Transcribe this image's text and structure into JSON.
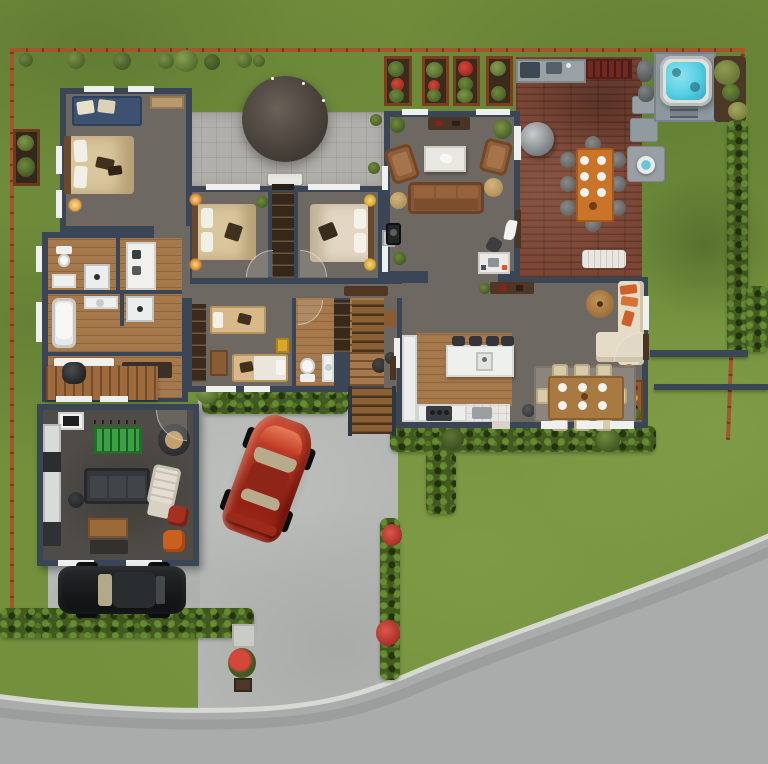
{
  "meta": {
    "kind": "architectural-site-plan-render",
    "view": "top-down",
    "canvas": {
      "width": 768,
      "height": 764
    },
    "visible_text": "none"
  },
  "palette": {
    "grass": "#73913d",
    "grassLight": "#8aa94e",
    "grassDark": "#55702c",
    "road": "#a9acaa",
    "curb": "#d9dbd5",
    "driveway": "#b6b8b6",
    "parkingPad": "#b0b2b0",
    "fence": "#a3562c",
    "fenceDark": "#713a18",
    "hedge": "#42591f",
    "hedgeLight": "#5d7a2e",
    "shrub": "#4f6b28",
    "tree": "#62793a",
    "soil": "#4c3826",
    "planterFrame": "#96502a",
    "flowerRed": "#c03228",
    "wall": "#3a4556",
    "floor": "#6e6862",
    "wood": "#a5794b",
    "woodDark": "#7c5432",
    "paver": "#b1afa9",
    "canopy": "#4a433c",
    "tile": "#e6e5e1",
    "rug": "#8b857d",
    "rugDark": "#33312e",
    "deck": "#7b4636",
    "counterGray": "#9aa1a4",
    "grillRed": "#6f2921",
    "steel": "#3c4854",
    "hotTubWater": "#54cfe2",
    "hotTubShell": "#dfe0de",
    "concretePad": "#8d979e",
    "rock": "#596063",
    "white": "#eef0ee",
    "cream": "#e6dcc6",
    "bedCream": "#d9c69c",
    "bedLight": "#e2d7c2",
    "tan": "#c4a36a",
    "pillowDark": "#42301f",
    "headboard": "#6a4a2e",
    "blueBench": "#3d5270",
    "sofaBrown": "#86573a",
    "armBrown": "#8e5f3a",
    "orange": "#cf5f28",
    "orangeTable": "#c97429",
    "chairTan": "#d8cbaa",
    "tableWood": "#a87940",
    "barWood": "#8a5c30",
    "consoleWood": "#503723",
    "darkWood": "#35271a",
    "island": "#eef0ee",
    "stool": "#333537",
    "appliance": "#3a3d3f",
    "black": "#232526",
    "gameFloor": "#4f4b46",
    "felt": "#3aa244",
    "poufRed": "#a33122",
    "poufOrange": "#cd5f1d",
    "sofaDark": "#35383b",
    "lounge": "#e3ddd0",
    "kitchenette": "#d9dbd9",
    "carRed": "#b23321",
    "carRedDark": "#8f2014",
    "carBlack": "#1b1d1f",
    "glass": "#b3a888",
    "lampGlow": "#ffb347",
    "yellowArt": "#d9a62e",
    "doorWood": "#4a3422",
    "outdoorChair": "#6e6e6c",
    "lowWall": "#3a4556",
    "gravel": "#98a0a5"
  },
  "site": {
    "ground": [
      "lawn",
      "street-curved-bottom-right",
      "sidewalk-curb",
      "driveway",
      "parking-pad"
    ],
    "boundary": [
      "fence-top",
      "fence-left",
      "fence-right"
    ],
    "greenery": [
      "hedge-front-left",
      "hedge-south-of-house",
      "hedge-spur",
      "hedge-lower-left",
      "hedge-east-fence",
      "hedge-northeast",
      "flower-bed-strip",
      "flower-bushes",
      "raised-beds-x4",
      "left-planter-box",
      "fence-line-shrubs",
      "trees-by-hot-tub"
    ],
    "hardscape": [
      "stone-path-pads",
      "boulders",
      "trash-pad",
      "exterior-wood-steps",
      "pergola-patio"
    ]
  },
  "house": {
    "wall_color": "#3a4556",
    "rooms": [
      {
        "name": "master-bedroom",
        "furniture": [
          "double-bed",
          "blue-bench",
          "dresser",
          "table-lamps"
        ]
      },
      {
        "name": "bedroom-2",
        "furniture": [
          "double-bed",
          "lamps",
          "plant"
        ]
      },
      {
        "name": "bedroom-3",
        "furniture": [
          "double-bed",
          "lamps"
        ]
      },
      {
        "name": "shared-wardrobe",
        "furniture": [
          "shelving"
        ]
      },
      {
        "name": "bathroom-block",
        "furniture": [
          "toilet",
          "shower",
          "shower-2",
          "bathtub",
          "sinks",
          "washer"
        ]
      },
      {
        "name": "hallway",
        "furniture": [
          "bench",
          "console"
        ]
      },
      {
        "name": "kids-bedroom",
        "furniture": [
          "single-bed-a",
          "single-bed-b",
          "wardrobe",
          "wall-art"
        ]
      },
      {
        "name": "small-bathroom",
        "furniture": [
          "toilet",
          "vanity"
        ]
      },
      {
        "name": "stairwell",
        "furniture": [
          "closet",
          "side-table"
        ]
      },
      {
        "name": "living-room",
        "furniture": [
          "sofa",
          "armchair-left",
          "armchair-right",
          "coffee-table",
          "poufs",
          "sideboard",
          "stove-unit",
          "desk",
          "desk-chair",
          "plants",
          "curtained-windows"
        ]
      },
      {
        "name": "family-area",
        "furniture": [
          "cream-sectional",
          "orange-pillows",
          "round-coffee-table",
          "console",
          "bar-cart",
          "pouf"
        ]
      },
      {
        "name": "kitchen",
        "furniture": [
          "island",
          "bar-stools-x4",
          "sink",
          "l-counter",
          "range",
          "trash-bin"
        ]
      },
      {
        "name": "dining-area",
        "furniture": [
          "dining-table",
          "chairs-x8",
          "place-settings",
          "area-rug"
        ]
      }
    ],
    "courtyard": [
      "paved-patio",
      "round-canopy",
      "white-bench",
      "shrubs"
    ]
  },
  "outdoor_living": {
    "deck": [
      "brick-decking",
      "outdoor-kitchen-counter",
      "grill-counter",
      "kettle-smoker",
      "outdoor-dining-table",
      "outdoor-chairs-x8",
      "white-lounger"
    ],
    "spa": [
      "hot-tub",
      "concrete-pad",
      "steps",
      "boulders",
      "fire-bowl"
    ]
  },
  "outbuilding": {
    "name": "game-room",
    "furniture": [
      "foosball-table",
      "dark-sofa",
      "ball-chair",
      "lounge-chair",
      "ottoman",
      "red-pouf",
      "orange-pouf",
      "coffee-table",
      "dark-rug",
      "kitchenette",
      "tv-unit"
    ]
  },
  "vehicles": [
    {
      "name": "red-sports-car",
      "color": "#b23321",
      "location": "driveway",
      "rotation_deg": 20
    },
    {
      "name": "black-car",
      "color": "#1b1d1f",
      "location": "parking-pad"
    }
  ]
}
